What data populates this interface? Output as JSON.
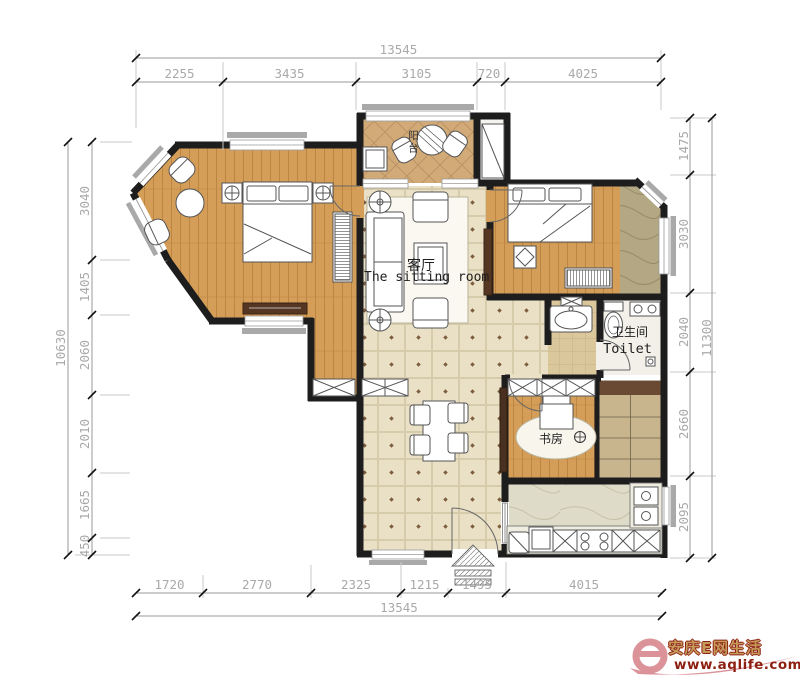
{
  "meta": {
    "type": "apartment floor plan drawing"
  },
  "rooms": {
    "sitting_room": {
      "zh": "客厅",
      "en": "The sitting room"
    },
    "toilet": {
      "zh": "卫生间",
      "en": "Toilet"
    },
    "study": {
      "zh": "书房"
    },
    "balcony": {
      "zh": "阳台"
    }
  },
  "dimensions": {
    "top": {
      "total": "13545",
      "segments": [
        "2255",
        "3435",
        "3105",
        "720",
        "4025"
      ]
    },
    "bottom": {
      "total": "13545",
      "segments": [
        "1720",
        "2770",
        "2325",
        "1215",
        "1495",
        "4015"
      ]
    },
    "left": {
      "total": "10630",
      "segments": [
        "3040",
        "1405",
        "2060",
        "2010",
        "1665",
        "450"
      ]
    },
    "right": {
      "total": "11300",
      "segments": [
        "1475",
        "3030",
        "2040",
        "2660",
        "2095"
      ]
    }
  },
  "watermark": {
    "brand": "安庆E网生活",
    "url": "www.aqlife.com"
  },
  "colors": {
    "wall": "#1d1d1d",
    "wood": "#d49d58",
    "tile": "#e9e0c6",
    "marble_dark": "#b3a784",
    "marble_light": "#dedbc8",
    "watermark_pink": "#db9298",
    "watermark_gold": "#c59a5b",
    "watermark_red": "#8d1f10"
  }
}
